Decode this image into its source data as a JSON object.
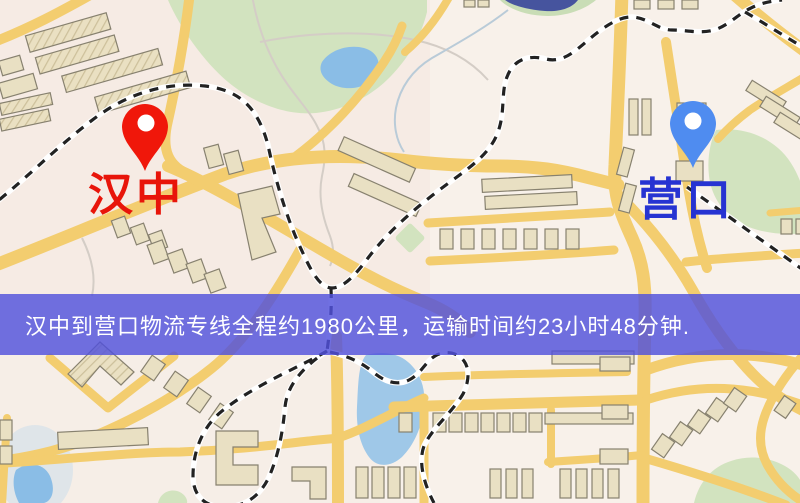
{
  "map": {
    "origin_marker": {
      "label": "汉中",
      "pin_color": "#f0170a",
      "label_color": "#e8150a"
    },
    "destination_marker": {
      "label": "营口",
      "pin_color": "#4f8cf0",
      "label_color": "#2633d2"
    },
    "banner": {
      "text": "汉中到营口物流专线全程约1980公里，运输时间约23小时48分钟.",
      "background_color": "#5050dc",
      "text_color": "#ffffff"
    },
    "palette": {
      "road": "#f3cd6f",
      "building": "#e9e0c3",
      "park": "#d2e3bf",
      "water": "#8abde6",
      "railway": "#222222",
      "background": "#f8f1ea"
    }
  }
}
